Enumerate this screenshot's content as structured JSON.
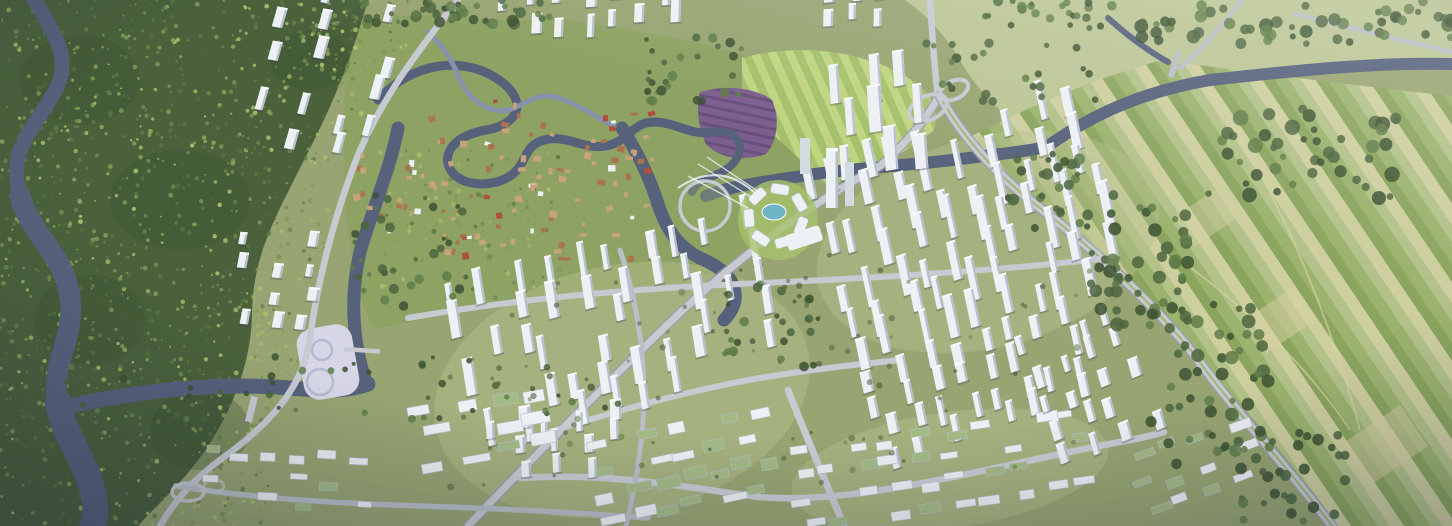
{
  "meta": {
    "description": "Aerial photograph of a rendered city master-plan: forested hills and a winding dark river on the west, an old riverine town and lakefront circular CBD plaza with a landmark tower in the center, large grids of white high-rise residential towers to the east and south, low-rise districts along the southern edge, a cloverleaf interchange and river to the northeast, and patchwork farmland in the east.",
    "image_type": "photographic-render",
    "width_px": 1452,
    "height_px": 526,
    "visible_text": []
  },
  "palette": {
    "base": "#98a572",
    "base_light": "#b6c08e",
    "meadow": "#bcc695",
    "parkland": "#8da263",
    "lawn": "#a6c26b",
    "lawn_light": "#c2d883",
    "farm1": "#b3c289",
    "farm2": "#9cb36f",
    "farm3": "#cecf9f",
    "farm4": "#8ba55f",
    "farm_path": "#d8d2a6",
    "forest": "#4a613c",
    "forest_dark": "#3c5233",
    "speckle1": "#7f9b55",
    "speckle2": "#a9c06c",
    "speckle3": "#5d7a45",
    "tree_dark": "#4c6540",
    "tree_mid": "#5f7d49",
    "water": "#56617b",
    "water_light": "#7d89a3",
    "stream": "#8691ab",
    "road": "#c7cad1",
    "road_minor": "#b9bec7",
    "road_dark": "#9aa0ac",
    "median_green": "#9cb26a",
    "building": "#edf0f4",
    "building_cap": "#f8fafc",
    "building_shade": "#b7bfcc",
    "building_glass": "#d2dae2",
    "building_shadow": "rgba(50,60,85,0.30)",
    "roof_green": "#a3ba85",
    "village_wall": "#c7a379",
    "village_roof": "#a9744e",
    "village_red": "#b04f3c",
    "purple_field": "#7d5f8f",
    "purple_dark": "#67507a",
    "pool_teal": "#6fb5c8",
    "platform_pale": "#d6d6e6",
    "platform_ring": "#b6b8cf"
  },
  "scene": {
    "regions": [
      "forest-west",
      "river-west",
      "hillside-towers-north",
      "old-town-riverine-village",
      "parkland-north",
      "purple-flower-field",
      "striped-lawns",
      "cbd-circular-plaza",
      "landmark-tower",
      "cable-stayed-bridge",
      "residential-towers-east",
      "residential-towers-south",
      "lowrise-districts-south",
      "campus-blocks-southwest",
      "riverside-platform",
      "farmland-east",
      "meadow-northeast",
      "cloverleaf-interchange",
      "southeast-arterial",
      "canal-and-river-network"
    ],
    "speckle_zones": [
      {
        "x": 0,
        "y": 0,
        "w": 362,
        "h": 140,
        "count": 330,
        "seed": 61
      },
      {
        "x": 0,
        "y": 130,
        "w": 330,
        "h": 140,
        "count": 300,
        "seed": 62
      },
      {
        "x": 0,
        "y": 260,
        "w": 300,
        "h": 130,
        "count": 270,
        "seed": 63
      },
      {
        "x": 0,
        "y": 380,
        "w": 270,
        "h": 146,
        "count": 240,
        "seed": 64
      },
      {
        "x": 300,
        "y": 0,
        "w": 110,
        "h": 70,
        "count": 70,
        "seed": 65
      },
      {
        "x": 380,
        "y": 150,
        "w": 180,
        "h": 140,
        "count": 120,
        "seed": 66
      }
    ],
    "tree_strips": [
      {
        "x": 1090,
        "y": 195,
        "w": 100,
        "h": 135,
        "count": 45,
        "rmin": 3,
        "rmax": 7,
        "seed": 41
      },
      {
        "x": 1150,
        "y": 300,
        "w": 120,
        "h": 165,
        "count": 55,
        "rmin": 3,
        "rmax": 7,
        "seed": 42
      },
      {
        "x": 1235,
        "y": 430,
        "w": 110,
        "h": 92,
        "count": 30,
        "rmin": 3,
        "rmax": 6,
        "seed": 43
      },
      {
        "x": 1005,
        "y": 148,
        "w": 85,
        "h": 80,
        "count": 28,
        "rmin": 2.5,
        "rmax": 6,
        "seed": 44
      },
      {
        "x": 360,
        "y": 0,
        "w": 200,
        "h": 26,
        "count": 42,
        "rmin": 2.5,
        "rmax": 6,
        "seed": 45
      },
      {
        "x": 1140,
        "y": 0,
        "w": 312,
        "h": 44,
        "count": 52,
        "rmin": 3,
        "rmax": 7,
        "seed": 46
      },
      {
        "x": 985,
        "y": 0,
        "w": 130,
        "h": 28,
        "count": 24,
        "rmin": 2.5,
        "rmax": 5,
        "seed": 47
      },
      {
        "x": 1200,
        "y": 108,
        "w": 200,
        "h": 95,
        "count": 45,
        "rmin": 3,
        "rmax": 8,
        "seed": 48
      },
      {
        "x": 60,
        "y": 356,
        "w": 560,
        "h": 64,
        "count": 52,
        "rmin": 2,
        "rmax": 4,
        "seed": 49
      },
      {
        "x": 430,
        "y": 255,
        "w": 660,
        "h": 235,
        "count": 85,
        "rmin": 1.5,
        "rmax": 3.5,
        "opacity": 0.55,
        "seed": 50
      },
      {
        "x": 925,
        "y": 40,
        "w": 185,
        "h": 62,
        "count": 24,
        "rmin": 2.5,
        "rmax": 5,
        "seed": 51
      },
      {
        "x": 350,
        "y": 195,
        "w": 120,
        "h": 125,
        "count": 34,
        "rmin": 2,
        "rmax": 5,
        "seed": 52
      },
      {
        "x": 640,
        "y": 36,
        "w": 115,
        "h": 68,
        "count": 28,
        "rmin": 2,
        "rmax": 5,
        "seed": 53
      },
      {
        "x": 700,
        "y": 280,
        "w": 120,
        "h": 90,
        "count": 30,
        "rmin": 2,
        "rmax": 5,
        "seed": 54
      }
    ],
    "clusters": [
      {
        "name": "towers-east",
        "x": 832,
        "y": 148,
        "w": 300,
        "h": 205,
        "angle": -18,
        "cols": 10,
        "rows": 7,
        "density": 0.78,
        "type": "tower",
        "bw": 8,
        "bh": 26,
        "hvar": 18,
        "seed": 11
      },
      {
        "name": "towers-east-south",
        "x": 880,
        "y": 352,
        "w": 235,
        "h": 105,
        "angle": -18,
        "cols": 8,
        "rows": 4,
        "density": 0.7,
        "type": "tower",
        "bw": 8,
        "bh": 20,
        "hvar": 10,
        "seed": 12
      },
      {
        "name": "towers-south",
        "x": 468,
        "y": 268,
        "w": 330,
        "h": 168,
        "angle": -15,
        "cols": 10,
        "rows": 6,
        "density": 0.74,
        "type": "tower",
        "bw": 8,
        "bh": 24,
        "hvar": 14,
        "seed": 13
      },
      {
        "name": "towers-southwest",
        "x": 492,
        "y": 428,
        "w": 150,
        "h": 72,
        "angle": -8,
        "cols": 5,
        "rows": 3,
        "density": 0.6,
        "type": "tower",
        "bw": 8,
        "bh": 16,
        "hvar": 7,
        "seed": 14
      },
      {
        "name": "lowrise-south-green",
        "x": 596,
        "y": 422,
        "w": 200,
        "h": 100,
        "angle": -12,
        "cols": 7,
        "rows": 4,
        "density": 0.85,
        "type": "low",
        "bw": 20,
        "bh": 9,
        "greenRatio": 0.55,
        "seed": 15
      },
      {
        "name": "hillside-towers-north",
        "x": 262,
        "y": 8,
        "w": 150,
        "h": 178,
        "angle": 10,
        "cols": 4,
        "rows": 6,
        "density": 0.62,
        "type": "tower",
        "bw": 8,
        "bh": 18,
        "hvar": 8,
        "seed": 16
      },
      {
        "name": "forest-edge-midrise",
        "x": 238,
        "y": 248,
        "w": 95,
        "h": 112,
        "angle": 5,
        "cols": 3,
        "rows": 4,
        "density": 0.72,
        "type": "tower",
        "bw": 8,
        "bh": 12,
        "hvar": 5,
        "seed": 17
      },
      {
        "name": "towers-top-center",
        "x": 498,
        "y": 4,
        "w": 195,
        "h": 54,
        "angle": -4,
        "cols": 7,
        "rows": 2,
        "density": 0.72,
        "type": "tower",
        "bw": 8,
        "bh": 16,
        "hvar": 8,
        "seed": 18
      },
      {
        "name": "towers-top-right",
        "x": 828,
        "y": 0,
        "w": 74,
        "h": 46,
        "angle": -5,
        "cols": 3,
        "rows": 2,
        "density": 0.7,
        "type": "tower",
        "bw": 8,
        "bh": 13,
        "hvar": 5,
        "seed": 19
      },
      {
        "name": "cbd-towers",
        "x": 842,
        "y": 92,
        "w": 104,
        "h": 118,
        "angle": -10,
        "cols": 3,
        "rows": 3,
        "density": 0.9,
        "type": "tower",
        "bw": 10,
        "bh": 32,
        "hvar": 16,
        "seed": 20
      },
      {
        "name": "lowrise-southeast",
        "x": 796,
        "y": 428,
        "w": 305,
        "h": 96,
        "angle": -8,
        "cols": 10,
        "rows": 4,
        "density": 0.8,
        "type": "low",
        "bw": 18,
        "bh": 8,
        "greenRatio": 0.3,
        "seed": 21
      },
      {
        "name": "midrise-east",
        "x": 1048,
        "y": 330,
        "w": 120,
        "h": 150,
        "angle": -22,
        "cols": 4,
        "rows": 5,
        "density": 0.72,
        "type": "tower",
        "bw": 8,
        "bh": 16,
        "hvar": 8,
        "seed": 22
      },
      {
        "name": "campus-blocks-southwest",
        "x": 420,
        "y": 392,
        "w": 142,
        "h": 82,
        "angle": -10,
        "cols": 4,
        "rows": 3,
        "density": 0.9,
        "type": "low",
        "bw": 24,
        "bh": 10,
        "greenRatio": 0.1,
        "seed": 23
      },
      {
        "name": "lowrise-riverside",
        "x": 198,
        "y": 452,
        "w": 185,
        "h": 70,
        "angle": 3,
        "cols": 6,
        "rows": 3,
        "density": 0.7,
        "type": "low",
        "bw": 16,
        "bh": 7,
        "greenRatio": 0.3,
        "seed": 24
      },
      {
        "name": "lowrise-east-green",
        "x": 1140,
        "y": 430,
        "w": 130,
        "h": 90,
        "angle": -20,
        "cols": 4,
        "rows": 3,
        "density": 0.8,
        "type": "low",
        "bw": 18,
        "bh": 8,
        "greenRatio": 0.5,
        "seed": 25
      }
    ],
    "villages": [
      {
        "name": "old-town",
        "x": 428,
        "y": 100,
        "w": 225,
        "h": 160,
        "count": 95,
        "seed": 31
      },
      {
        "name": "resort-village",
        "x": 352,
        "y": 150,
        "w": 70,
        "h": 80,
        "count": 18,
        "seed": 32
      }
    ],
    "cbd": {
      "cx": 776,
      "cy": 216,
      "plaza_radius": 40,
      "ring_buildings": 7,
      "ring_radius": 27,
      "tower": {
        "x": 826,
        "y": 150,
        "w": 12,
        "h": 58
      }
    }
  }
}
